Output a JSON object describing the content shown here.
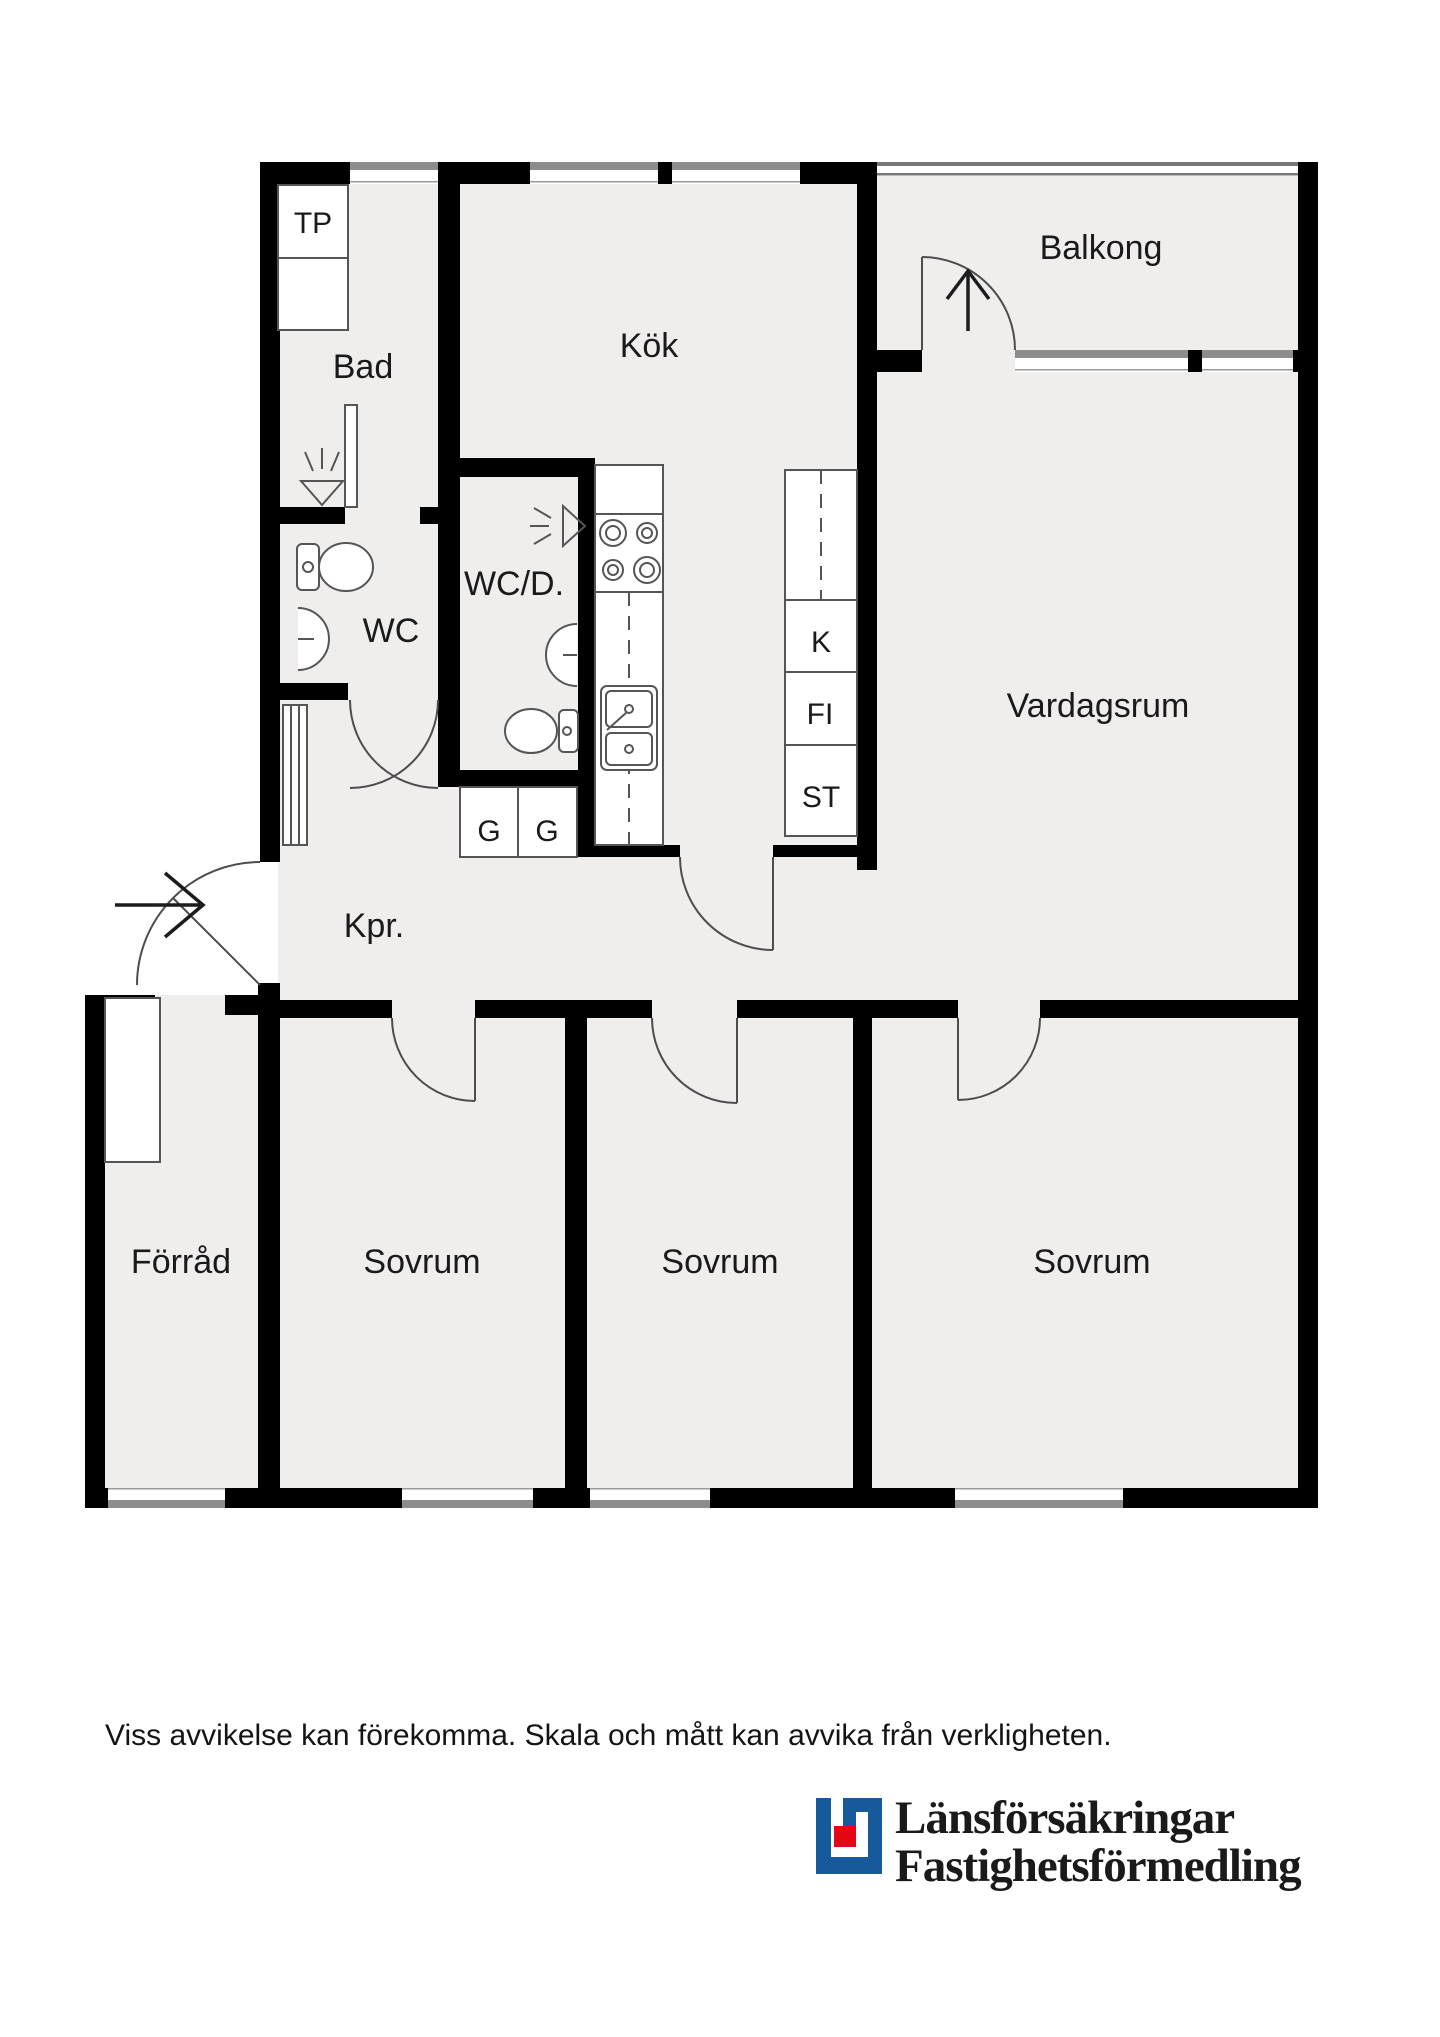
{
  "plan": {
    "wall_color": "#000000",
    "floor_color": "#F0EDED",
    "window_gray": "#8D8D8D",
    "rooms": {
      "tp": "TP",
      "bad": "Bad",
      "kok": "Kök",
      "balkong": "Balkong",
      "wc": "WC",
      "wcd": "WC/D.",
      "k": "K",
      "fi": "FI",
      "st": "ST",
      "vardagsrum": "Vardagsrum",
      "kpr": "Kpr.",
      "g1": "G",
      "g2": "G",
      "forrad": "Förråd",
      "sovrum1": "Sovrum",
      "sovrum2": "Sovrum",
      "sovrum3": "Sovrum"
    }
  },
  "footer": {
    "disclaimer": "Viss avvikelse kan förekomma. Skala och mått kan avvika från verkligheten."
  },
  "logo": {
    "line1": "Länsförsäkringar",
    "line2": "Fastighetsförmedling",
    "blue": "#165A9C",
    "red": "#E30613"
  }
}
